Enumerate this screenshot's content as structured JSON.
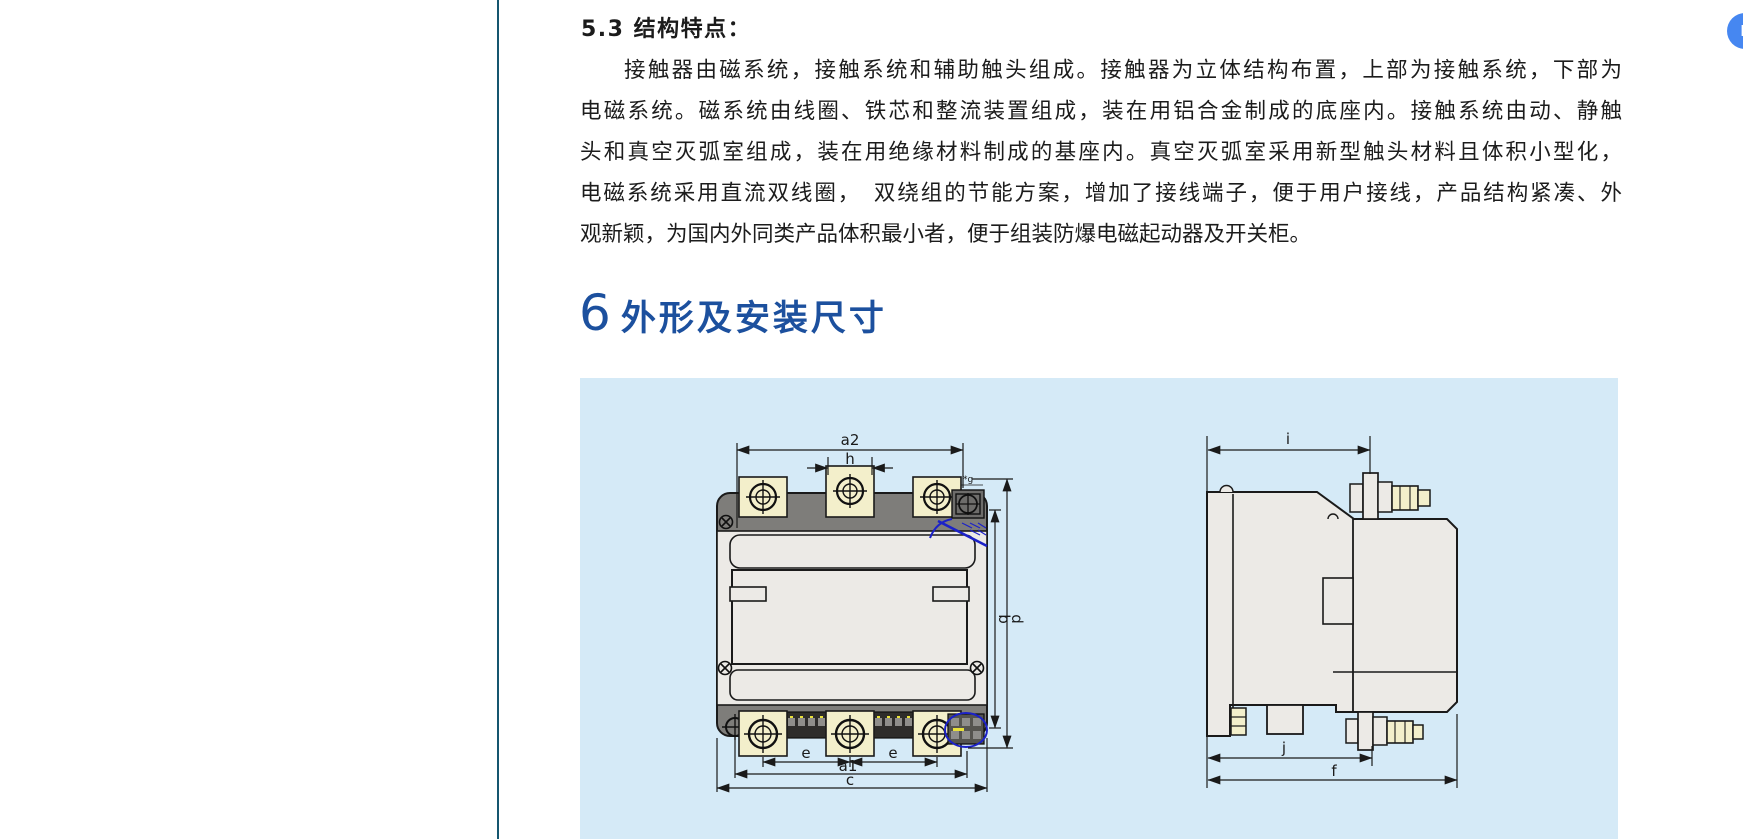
{
  "document": {
    "section_heading": "5.3 结构特点：",
    "paragraph_lines": [
      "接触器由磁系统，接触系统和辅助触头组成。接触器为立体结构布置，上部为接触系统，下部为",
      "电磁系统。磁系统由线圈、铁芯和整流装置组成，装在用铝合金制成的底座内。接触系统由动、静触",
      "头和真空灭弧室组成，装在用绝缘材料制成的基座内。真空灭弧室采用新型触头材料且体积小型化，",
      "电磁系统采用直流双线圈，　双绕组的节能方案，增加了接线端子，便于用户接线，产品结构紧凑、外",
      "观新颖，为国内外同类产品体积最小者，便于组装防爆电磁起动器及开关柜。"
    ],
    "chapter": {
      "number": "6",
      "title": "外形及安装尺寸"
    }
  },
  "figure": {
    "front_view": {
      "labels": {
        "a2": "a2",
        "h": "h",
        "g": "*g",
        "b": "b",
        "d": "d",
        "e1": "e",
        "e2": "e",
        "a1": "a1",
        "c": "c"
      }
    },
    "side_view": {
      "labels": {
        "i": "i",
        "j": "j",
        "f": "f"
      }
    }
  },
  "floating_button": {
    "label": "L"
  },
  "colors": {
    "divider": "#15566f",
    "chapter_heading_blue": "#1c509e",
    "figure_background": "#d5eaf7",
    "drawing_body_gray": "#eceae6",
    "drawing_band_gray": "#7e7d7a",
    "terminal_cream": "#f3efcb",
    "accent_blue": "#1b21c8",
    "floating_button_blue": "#4687f1"
  }
}
